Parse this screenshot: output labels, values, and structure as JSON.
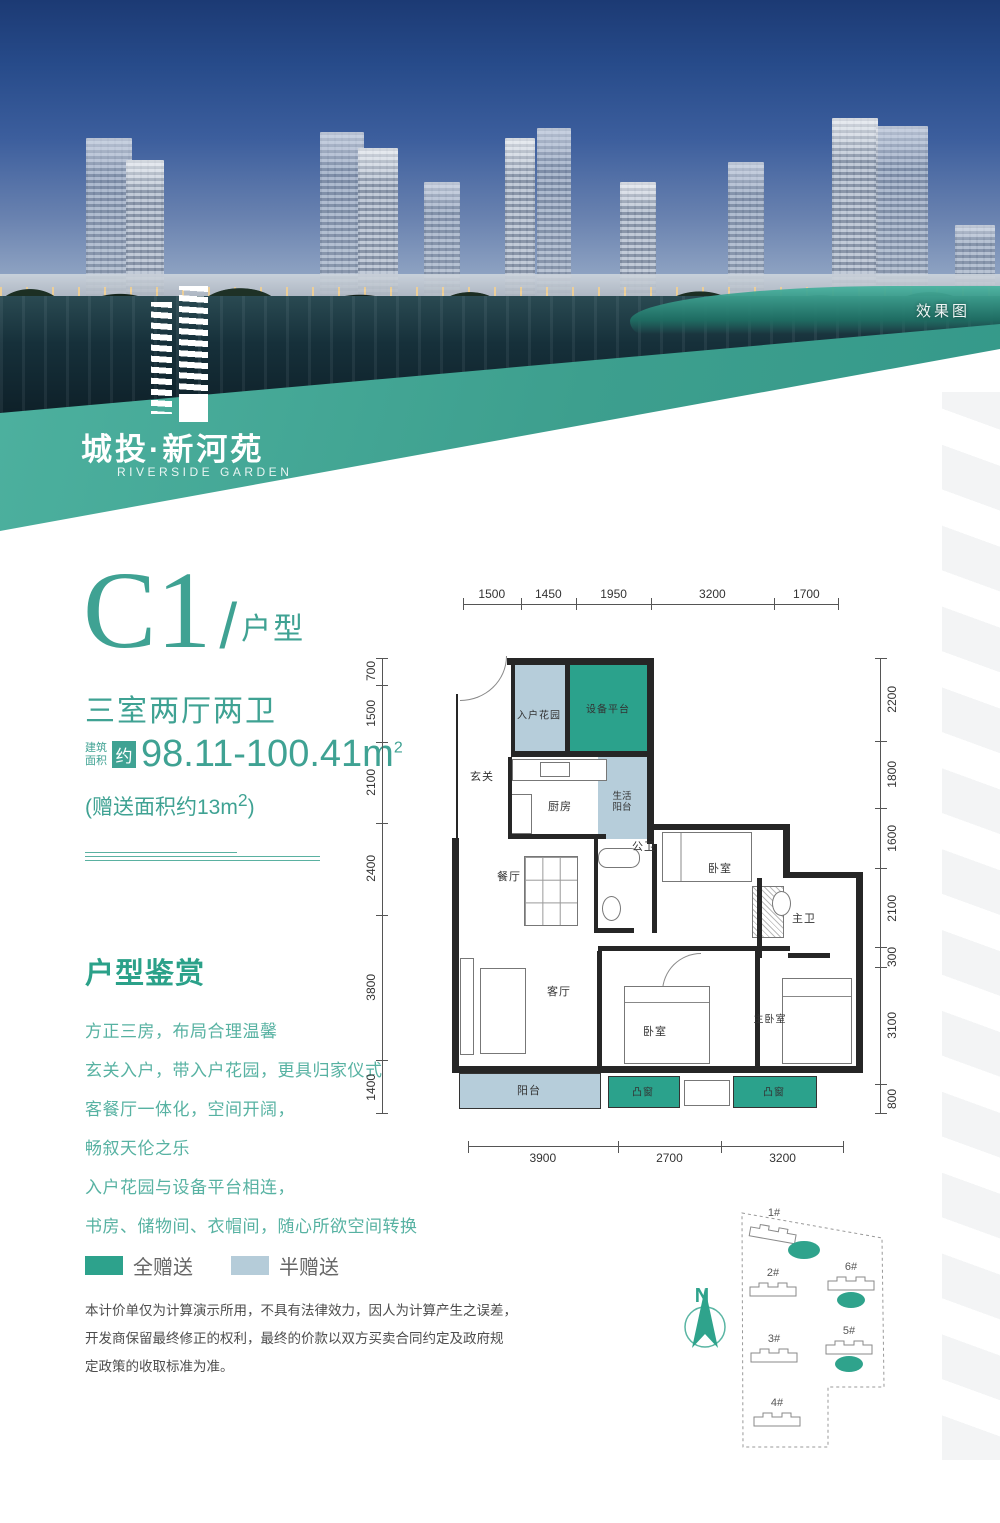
{
  "page": {
    "render_label": "效果图"
  },
  "brand": {
    "name_cn": "城投·新河苑",
    "name_en": "RIVERSIDE GARDEN"
  },
  "unit": {
    "code": "C1",
    "slash": "/",
    "type_suffix": "户型",
    "layout_summary": "三室两厅两卫",
    "area_label_top": "建筑",
    "area_label_bottom": "面积",
    "area_badge": "约",
    "area_value": "98.11-100.41m",
    "area_sup": "2",
    "bonus_prefix": "(赠送面积约13m",
    "bonus_sup": "2",
    "bonus_suffix": ")"
  },
  "appreciation": {
    "title": "户型鉴赏",
    "lines": [
      "方正三房，布局合理温馨",
      "玄关入户，带入户花园，更具归家仪式",
      "客餐厅一体化，空间开阔，",
      "畅叙天伦之乐",
      "入户花园与设备平台相连，",
      "书房、储物间、衣帽间，随心所欲空间转换"
    ]
  },
  "legend": {
    "items": [
      {
        "label": "全赠送",
        "color": "#2da28c"
      },
      {
        "label": "半赠送",
        "color": "#b5ccd9"
      }
    ]
  },
  "disclaimer": {
    "lines": [
      "本计价单仅为计算演示所用，不具有法律效力，因人为计算产生之误差，",
      "开发商保留最终修正的权利，最终的价款以双方买卖合同约定及政府规",
      "定政策的收取标准为准。"
    ]
  },
  "floorplan": {
    "dims_top": [
      "1500",
      "1450",
      "1950",
      "3200",
      "1700"
    ],
    "dims_left": [
      "700",
      "1500",
      "2100",
      "2400",
      "3800",
      "1400"
    ],
    "dims_right": [
      "2200",
      "1800",
      "1600",
      "2100",
      "300",
      "3100",
      "800"
    ],
    "dims_bottom": [
      "3900",
      "2700",
      "3200"
    ],
    "rooms": {
      "entry_garden": "入户花园",
      "equipment_platform": "设备平台",
      "foyer": "玄关",
      "kitchen": "厨房",
      "service_balcony": "生活阳台",
      "dining": "餐厅",
      "guest_bath": "公卫",
      "bedroom_a": "卧室",
      "master_bath": "主卫",
      "living": "客厅",
      "bedroom_b": "卧室",
      "master_bedroom": "主卧室",
      "balcony": "阳台",
      "bay_window": "凸窗"
    },
    "legend_colors": {
      "full_gift": "#2ba28c",
      "half_gift": "#b6cdda"
    }
  },
  "siteplan": {
    "north_label": "N",
    "buildings": [
      "1#",
      "2#",
      "3#",
      "4#",
      "5#",
      "6#"
    ]
  }
}
